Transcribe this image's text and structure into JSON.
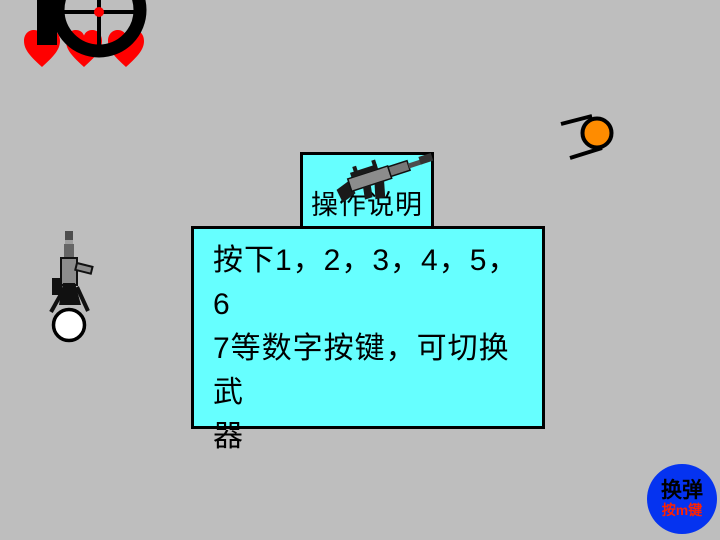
{
  "background_color": "#bebebe",
  "hud": {
    "lives": 3,
    "heart_color": "#ff0000",
    "scope_icon": "sniper-scope",
    "scope_color": "#000000",
    "scope_dot_color": "#ff0000"
  },
  "entities": {
    "player": {
      "type": "player-top-down-with-rifle",
      "head_color": "#ffffff",
      "gun_color": "#8c8c8c"
    },
    "enemy": {
      "type": "enemy-top-down",
      "color": "#ff8c00"
    }
  },
  "help": {
    "panel_color": "#66ffff",
    "border_color": "#000000",
    "title": "操作说明",
    "weapon_icon": "assault-rifle",
    "lines": [
      "按下1，2，3，4，5，6",
      "7等数字按键，可切换武",
      "器"
    ],
    "full_text": "按下1，2，3，4，5，6 7等数字按键，可切换武器"
  },
  "reload": {
    "label": "换弹",
    "sublabel": "按m键",
    "button_color": "#0533f0",
    "label_color": "#000000",
    "sublabel_color": "#ff2200"
  }
}
